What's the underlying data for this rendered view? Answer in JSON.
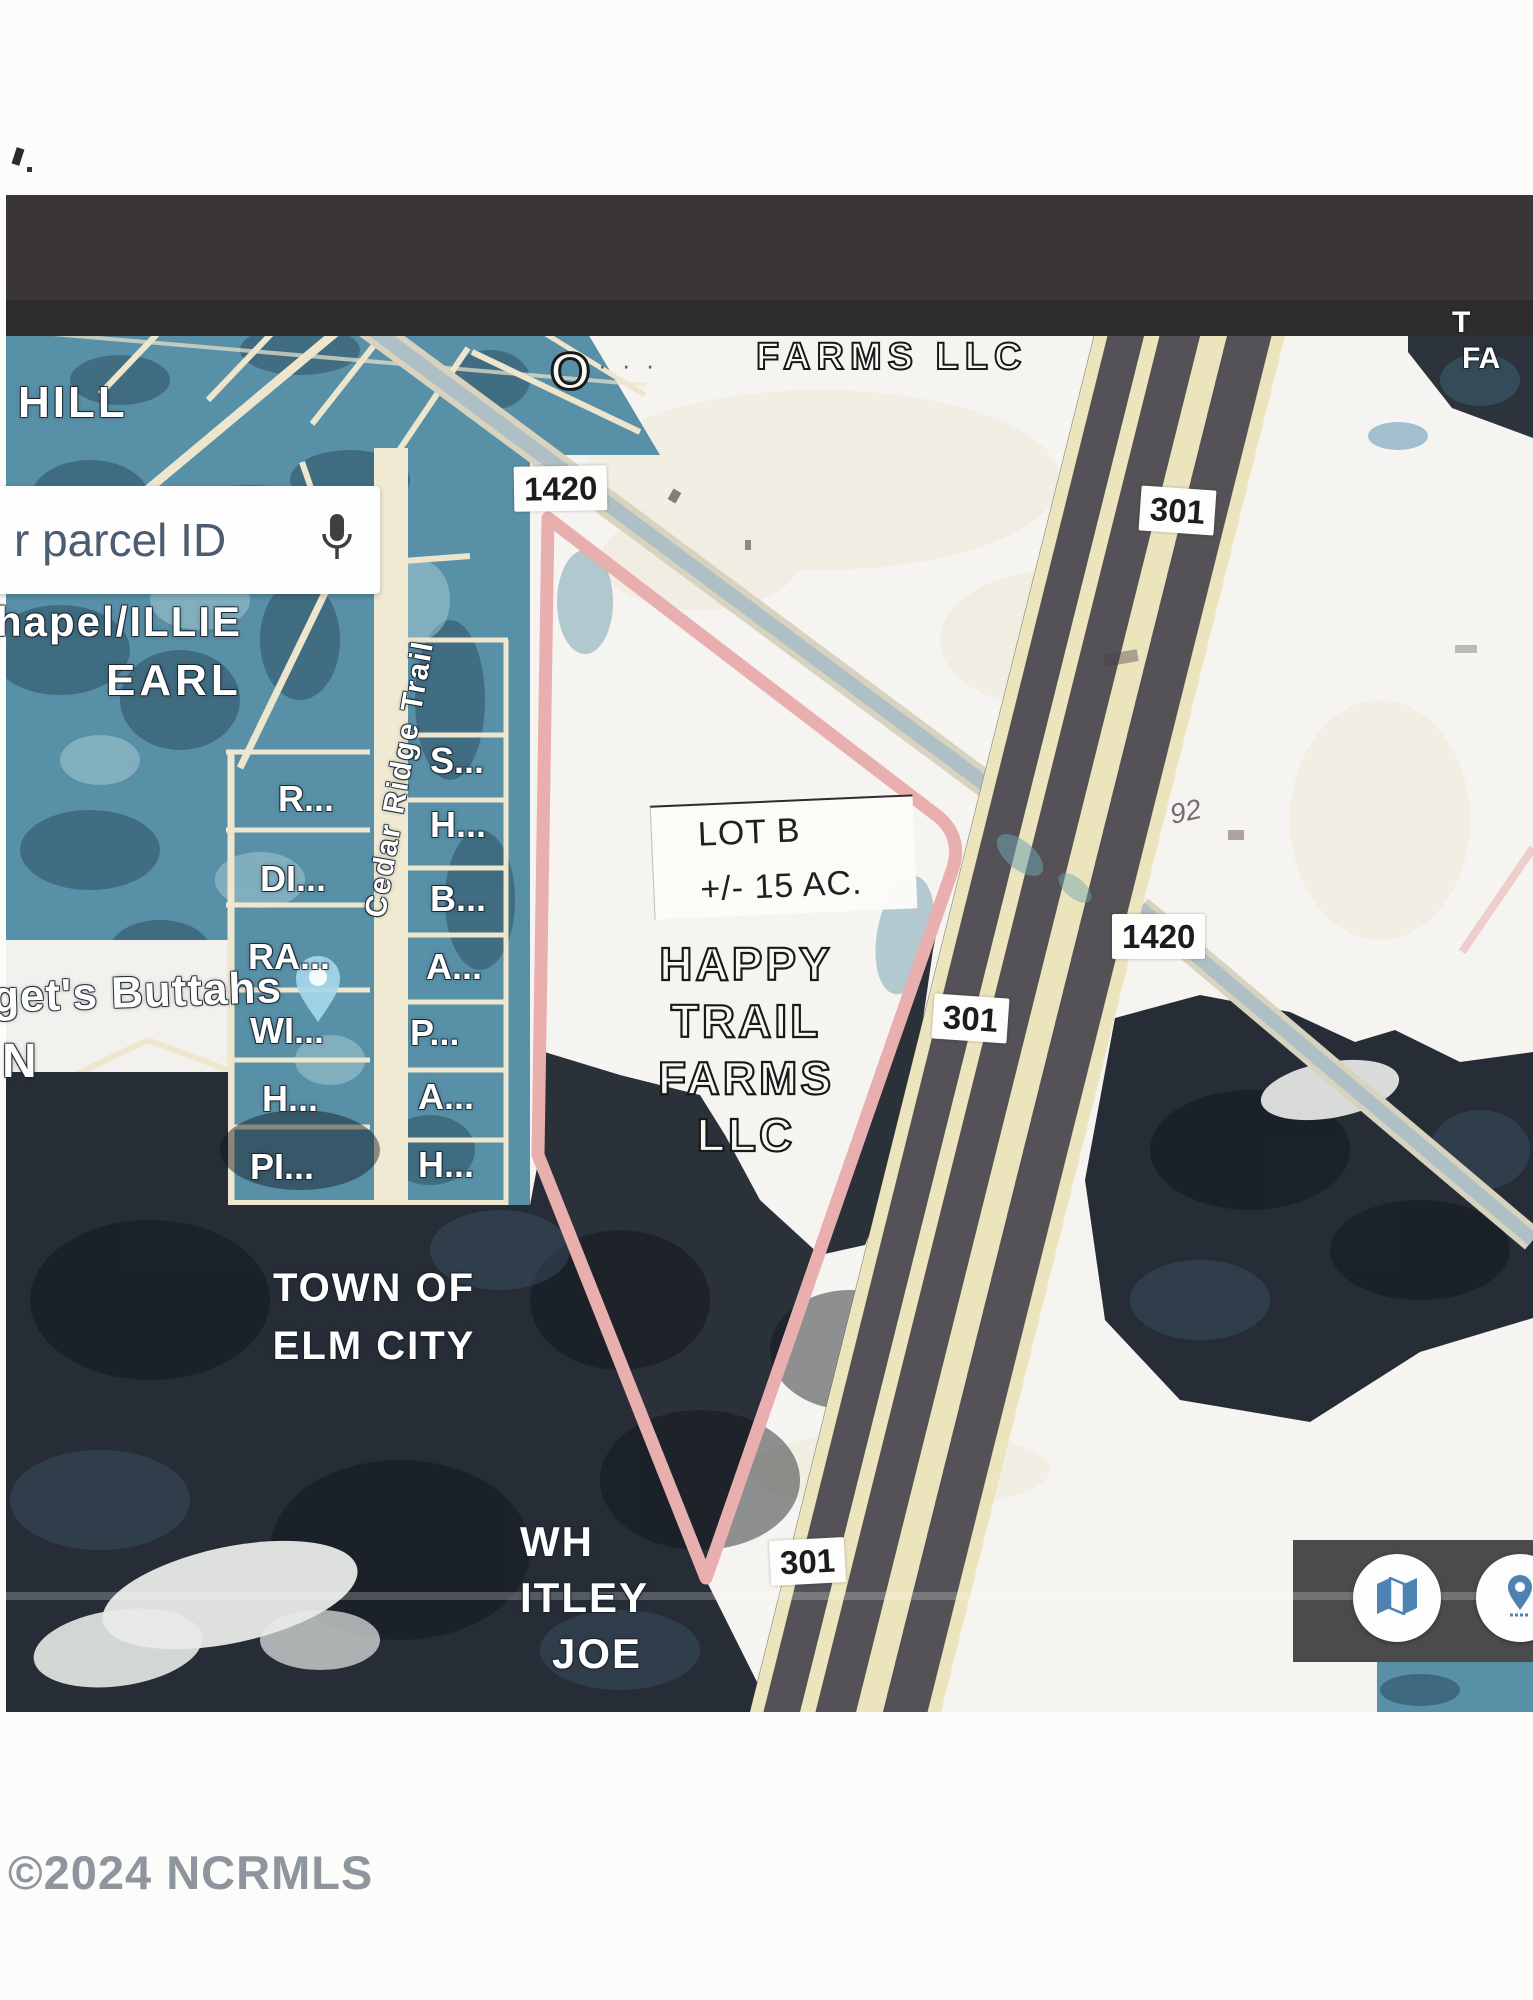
{
  "map": {
    "region_labels": {
      "hill": "HILL",
      "chapel_illie": "hapel/ILLIE",
      "earl": "EARL",
      "farms_llc_top": "FARMS LLC",
      "letter_o": "O",
      "scan_dots": "· · ·",
      "top_right_t": "T",
      "top_right_fa": "FA",
      "street": "Cedar Ridge Trail",
      "buttahs": "get's Buttahs",
      "n": "N",
      "town_of": "TOWN OF",
      "elm_city": "ELM CITY",
      "wh": "WH",
      "itley": "ITLEY",
      "joe": "JOE",
      "handwritten": "92"
    },
    "parcel_labels": [
      "R...",
      "DI...",
      "RA...",
      "WI...",
      "H...",
      "PI...",
      "S...",
      "H...",
      "B...",
      "A...",
      "P...",
      "A...",
      "H..."
    ],
    "lot": {
      "name": "LOT B",
      "acreage": "+/- 15 AC."
    },
    "owner_lines": [
      "HAPPY",
      "TRAIL",
      "FARMS",
      "LLC"
    ],
    "road_chips": [
      {
        "id": "sr-1420-nw",
        "text": "1420"
      },
      {
        "id": "us-301-top",
        "text": "301"
      },
      {
        "id": "sr-1420-se",
        "text": "1420"
      },
      {
        "id": "us-301-mid",
        "text": "301"
      },
      {
        "id": "us-301-bottom",
        "text": "301"
      }
    ]
  },
  "search": {
    "value": "r parcel ID"
  },
  "watermark": "©2024 NCRMLS",
  "icons": {
    "microphone": "microphone-icon",
    "map_button": "folded-map-icon",
    "pin_button": "location-pin-icon",
    "map_marker": "teardrop-pin"
  },
  "colors": {
    "boundary_pink": "#e9aeae",
    "aerial_teal": "#5890a8",
    "woods_dark": "#262d36",
    "road_cream": "#ece4bc",
    "highway_gray": "#545257",
    "top_band": "#3a3638",
    "accent_blue": "#4d82b2",
    "label_white": "#ffffff"
  }
}
